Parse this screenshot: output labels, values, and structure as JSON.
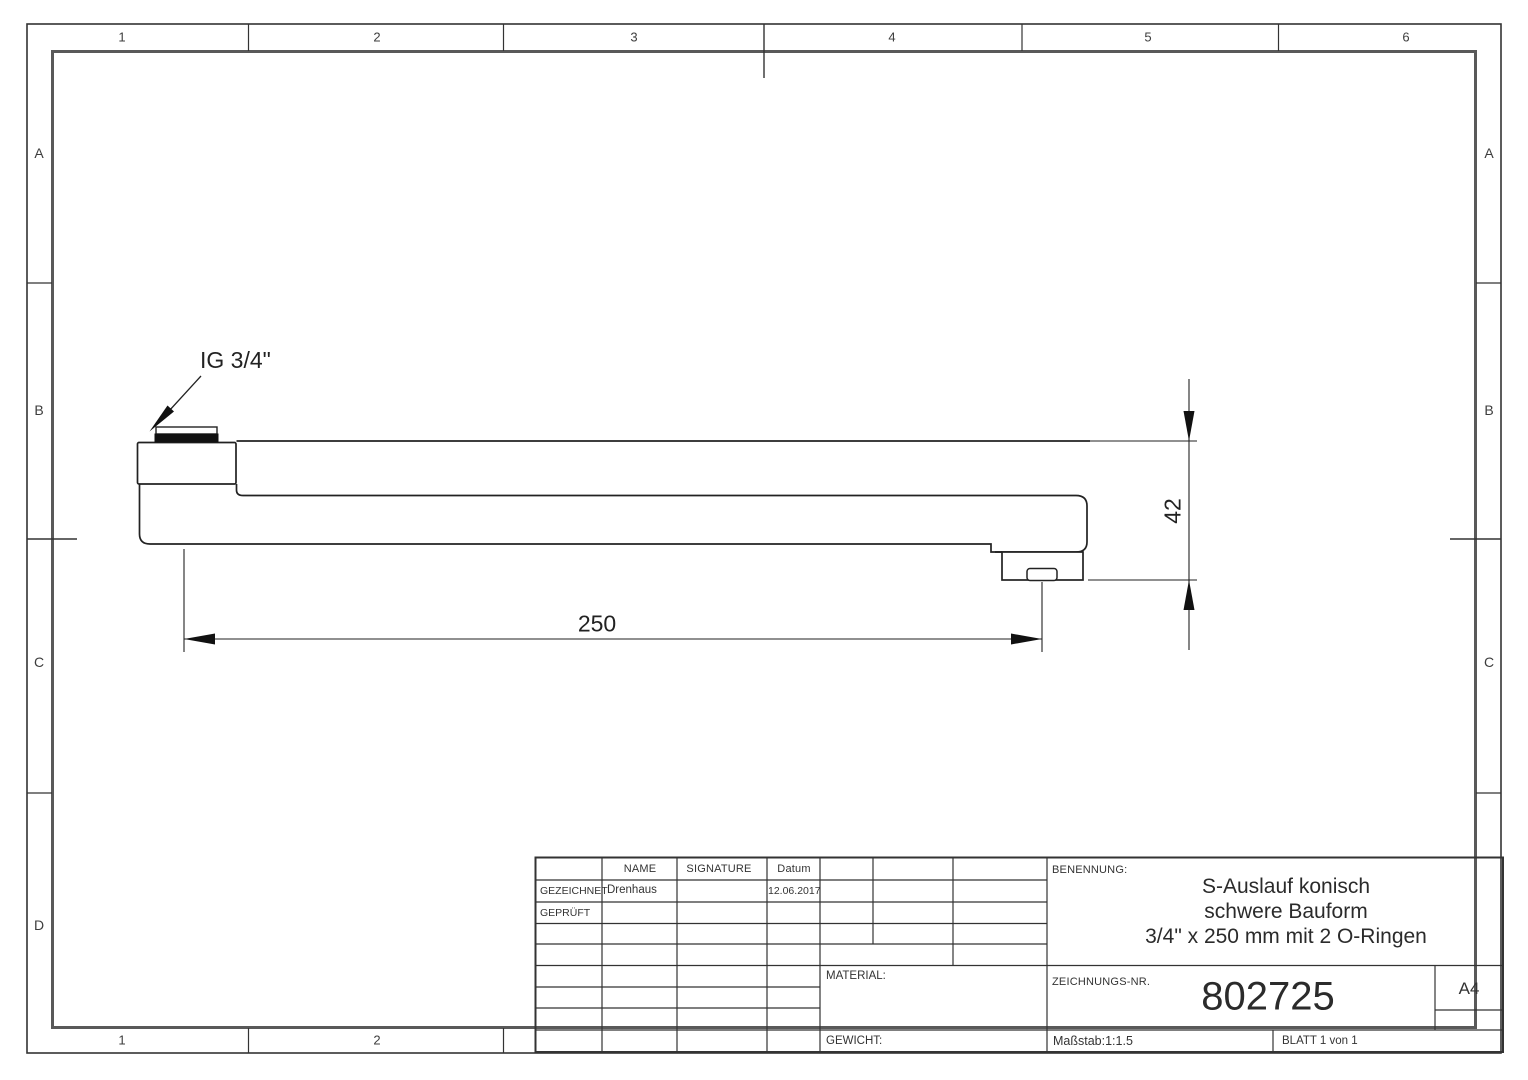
{
  "sheet": {
    "paper": "A4",
    "zones_top": [
      "1",
      "2",
      "3",
      "4",
      "5",
      "6"
    ],
    "zones_bottom": [
      "1",
      "2"
    ],
    "zones_left": [
      "A",
      "B",
      "C",
      "D"
    ],
    "zones_right": [
      "A",
      "B",
      "C"
    ]
  },
  "drawing": {
    "thread_label": "IG 3/4\"",
    "length_dim": "250",
    "height_dim": "42"
  },
  "title_block": {
    "col_name": "NAME",
    "col_signature": "SIGNATURE",
    "col_date": "Datum",
    "row_drawn_label": "GEZEICHNET",
    "row_drawn_name": "Drenhaus",
    "row_drawn_date": "12.06.2017",
    "row_checked_label": "GEPRÜFT",
    "material_label": "MATERIAL:",
    "weight_label": "GEWICHT:",
    "name_label": "BENENNUNG:",
    "title_line1": "S-Auslauf konisch",
    "title_line2": "schwere Bauform",
    "title_line3": "3/4\" x 250 mm mit 2 O-Ringen",
    "drawing_no_label": "ZEICHNUNGS-NR.",
    "drawing_no": "802725",
    "format": "A4",
    "scale": "Maßstab:1:1.5",
    "sheet": "BLATT 1 von 1"
  },
  "colors": {
    "line": "#2b2b2b",
    "frame": "#595959",
    "text": "#333333",
    "background": "#ffffff"
  }
}
